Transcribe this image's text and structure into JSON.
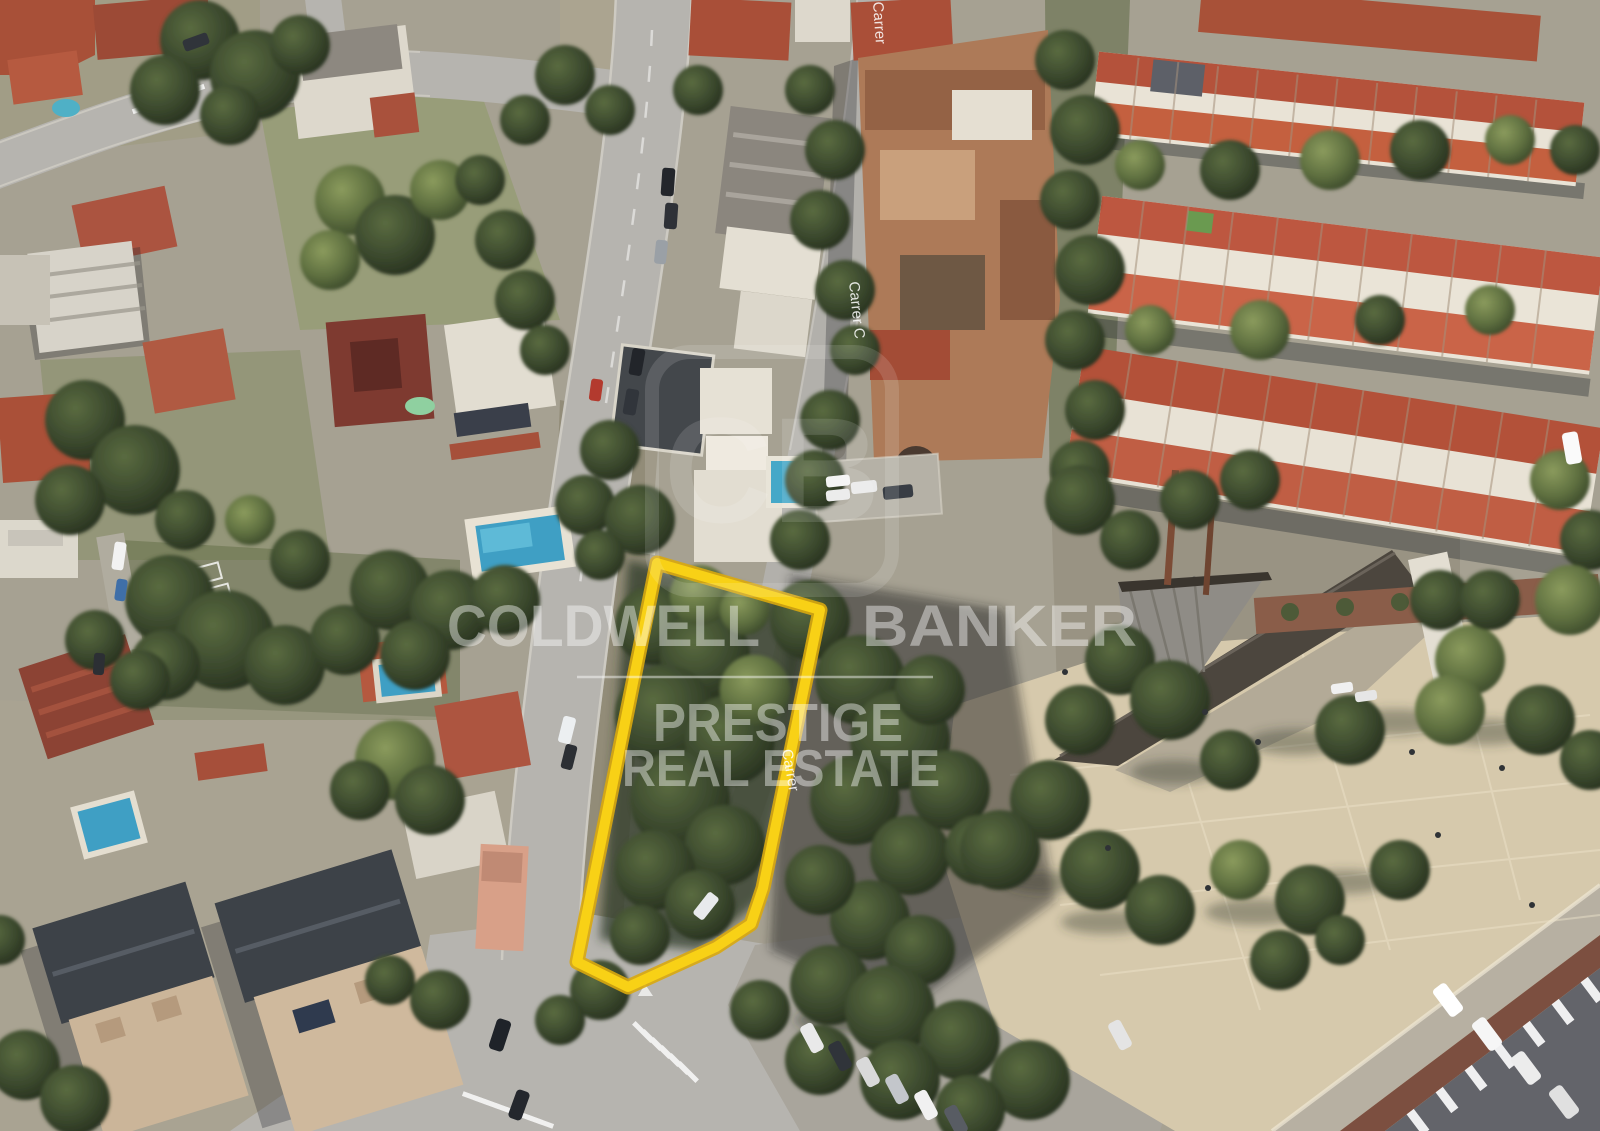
{
  "watermark": {
    "brand_word1": "COLDWELL",
    "brand_word2": "BANKER",
    "sub_line1": "PRESTIGE",
    "sub_line2": "REAL ESTATE",
    "logo_monogram": "CB",
    "color": "#FFFFFF"
  },
  "street_labels": [
    {
      "text": "Carrer"
    },
    {
      "text": "Carrer C"
    },
    {
      "text": "Carrer"
    }
  ],
  "plot_highlight": {
    "color": "#F8D116",
    "edge_color": "#D9A90E"
  }
}
